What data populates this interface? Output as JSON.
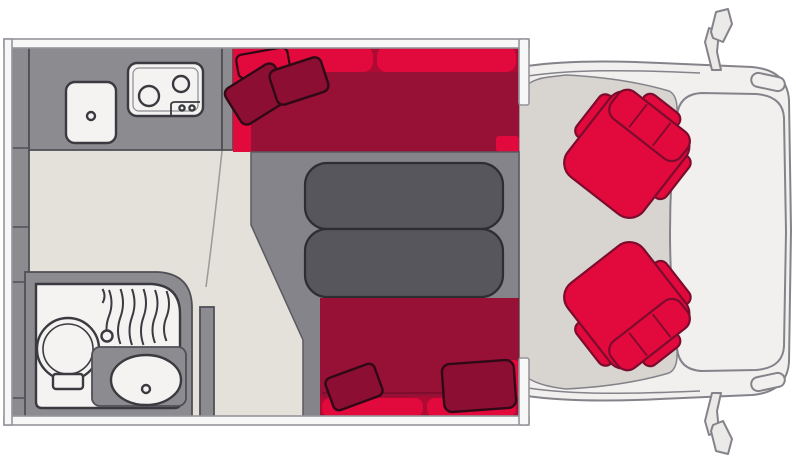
{
  "meta": {
    "title": "Motorhome floor plan (top view)",
    "width_px": 796,
    "height_px": 466,
    "visible_text": "none"
  },
  "colors": {
    "background": "#ffffff",
    "bright_red": "#e2093c",
    "dark_red": "#971036",
    "deep_red": "#ae0a34",
    "pillow_red": "#8c0f33",
    "pillow_outline": "#2f0916",
    "seat_outline": "#7c0c2d",
    "unit_gray": "#8c8b90",
    "unit_outline": "#504f56",
    "fixture_white": "#f4f3f1",
    "fixture_outline": "#3b3a40",
    "table_gray": "#57565c",
    "table_outline": "#2e2d33",
    "platform_gray": "#85848a",
    "platform_outline": "#5a5960",
    "floor_beige": "#e4e1db",
    "cab_floor": "#d8d5d0",
    "body_white": "#f1f0ee",
    "body_line": "#84838a",
    "mirror_fill": "#eceae8",
    "wall_fill": "#f7f7f7",
    "wall_line": "#96959b",
    "seam_line": "#9b9a97"
  },
  "layout": {
    "rear_wardrobe_column": {
      "label": "rear storage column",
      "segments": 5
    },
    "kitchen": {
      "label": "kitchen",
      "items": [
        "worktop",
        "sink with drain",
        "two-burner hob",
        "hob control knobs"
      ]
    },
    "bathroom": {
      "label": "bathroom",
      "items": [
        "toilet",
        "shower curtain",
        "shower faucet",
        "vanity counter",
        "washbasin with drain"
      ]
    },
    "lounge": {
      "label": "lounge dinette",
      "items": [
        "front bench",
        "rear bench",
        "backrest cushions",
        "two-part table",
        "seating platform",
        "scatter cushions x5"
      ]
    },
    "cab": {
      "label": "driver cab",
      "items": [
        "passenger swivel seat",
        "driver swivel seat",
        "bonnet",
        "windscreen outline",
        "wing mirror top",
        "wing mirror bottom",
        "headlights"
      ]
    }
  }
}
